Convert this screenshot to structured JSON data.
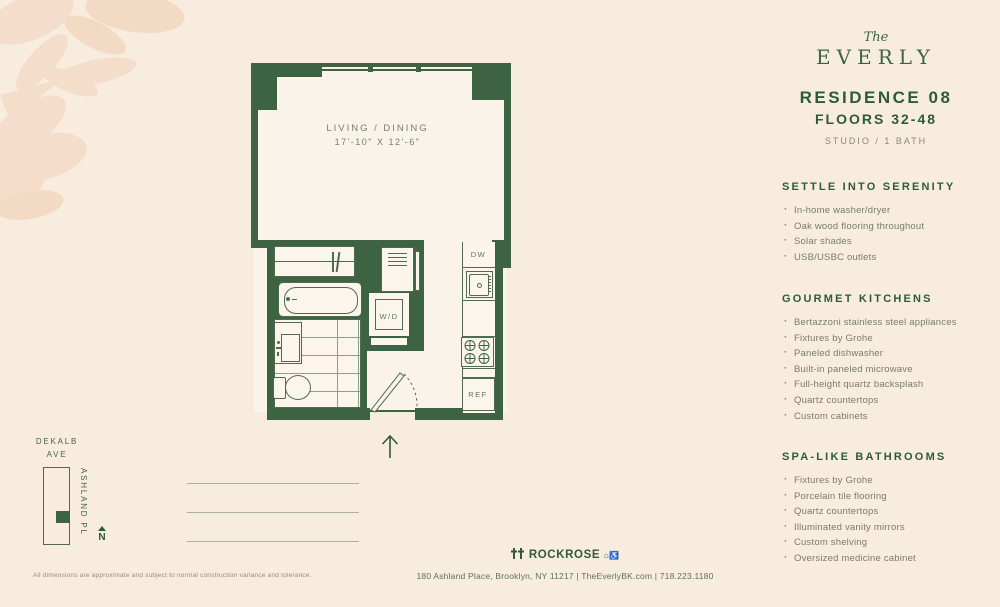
{
  "logo": {
    "script": "The",
    "name": "EVERLY"
  },
  "residence": {
    "title": "RESIDENCE 08",
    "floors": "FLOORS 32-48",
    "type": "STUDIO / 1 BATH"
  },
  "sections": [
    {
      "heading": "SETTLE INTO SERENITY",
      "items": [
        "In-home washer/dryer",
        "Oak wood flooring throughout",
        "Solar shades",
        "USB/USBC outlets"
      ]
    },
    {
      "heading": "GOURMET KITCHENS",
      "items": [
        "Bertazzoni stainless steel appliances",
        "Fixtures by Grohe",
        "Paneled dishwasher",
        "Built-in paneled microwave",
        "Full-height quartz backsplash",
        "Quartz countertops",
        "Custom cabinets"
      ]
    },
    {
      "heading": "SPA-LIKE BATHROOMS",
      "items": [
        "Fixtures by Grohe",
        "Porcelain tile flooring",
        "Quartz countertops",
        "Illuminated vanity mirrors",
        "Custom shelving",
        "Oversized medicine cabinet"
      ]
    }
  ],
  "plan": {
    "room_label": "LIVING / DINING",
    "room_dims": "17'-10\" X 12'-6\"",
    "labels": {
      "dw": "DW",
      "wd": "W/D",
      "ref": "REF"
    }
  },
  "map": {
    "street_top_line1": "DEKALB",
    "street_top_line2": "AVE",
    "street_side": "ASHLAND PL",
    "compass": "N"
  },
  "footer": {
    "disclaimer": "All dimensions are approximate and subject to normal construction variance and tolerance.",
    "brand": "ROCKROSE",
    "icons": "rockrose-mark, equal-housing-icon, accessibility-icon",
    "address": "180 Ashland Place, Brooklyn, NY 11217 | TheEverlyBK.com | 718.223.1180"
  },
  "colors": {
    "background": "#f8ecdf",
    "wall_green": "#3e6343",
    "brand_green": "#2e5a3b",
    "muted_text": "#797c69",
    "leaf": "#f4ddca"
  }
}
